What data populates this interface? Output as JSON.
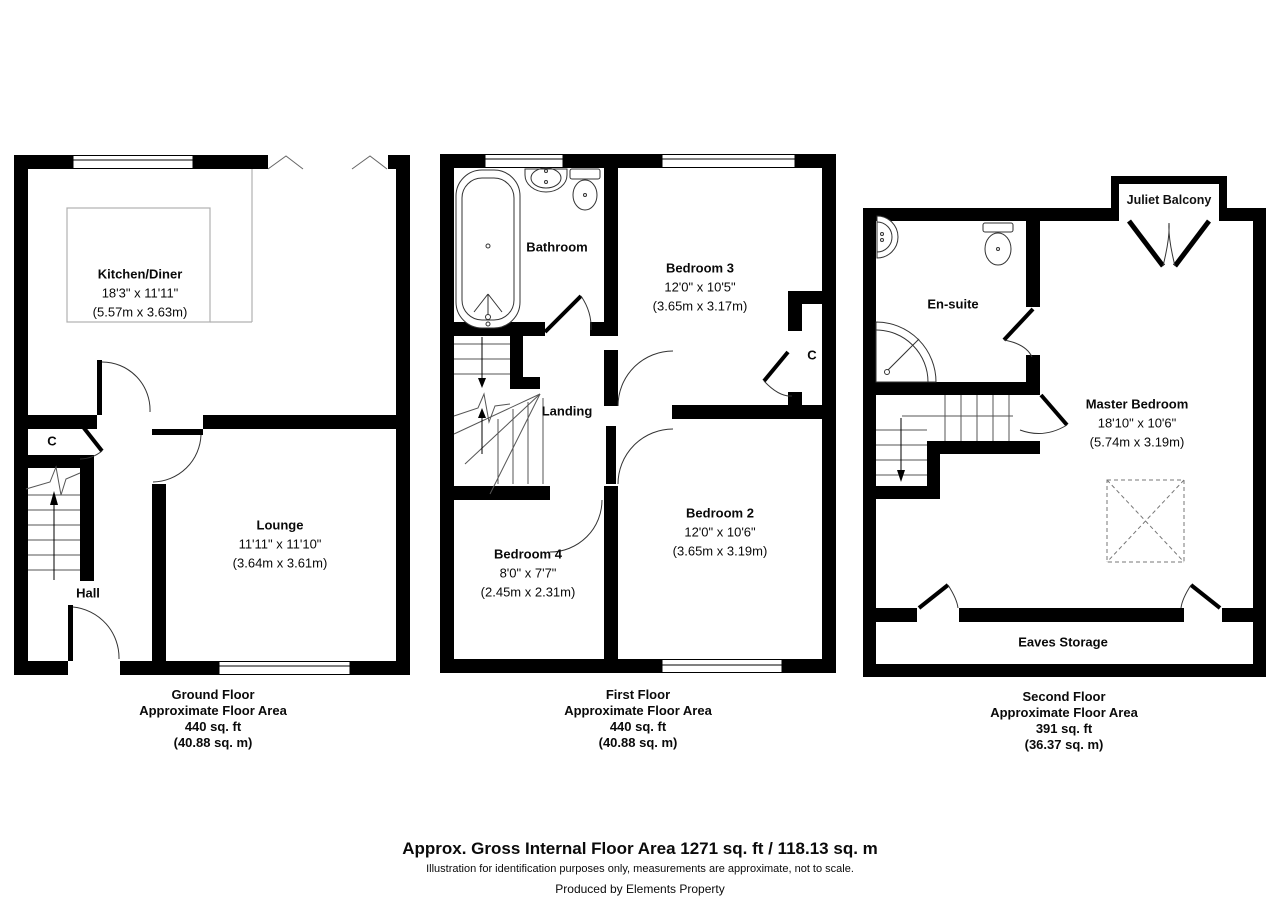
{
  "floors": [
    {
      "id": "ground",
      "caption": {
        "title": "Ground Floor",
        "subtitle": "Approximate Floor Area",
        "area_ft": "440 sq. ft",
        "area_m": "(40.88 sq. m)"
      },
      "rooms": {
        "kitchen_diner": {
          "name": "Kitchen/Diner",
          "dims_ft": "18'3\" x 11'11\"",
          "dims_m": "(5.57m x 3.63m)"
        },
        "lounge": {
          "name": "Lounge",
          "dims_ft": "11'11\" x 11'10\"",
          "dims_m": "(3.64m x 3.61m)"
        },
        "hall": {
          "name": "Hall"
        },
        "cupboard": {
          "name": "C"
        }
      }
    },
    {
      "id": "first",
      "caption": {
        "title": "First Floor",
        "subtitle": "Approximate Floor Area",
        "area_ft": "440 sq. ft",
        "area_m": "(40.88 sq. m)"
      },
      "rooms": {
        "bathroom": {
          "name": "Bathroom"
        },
        "bedroom3": {
          "name": "Bedroom 3",
          "dims_ft": "12'0\" x 10'5\"",
          "dims_m": "(3.65m x 3.17m)"
        },
        "landing": {
          "name": "Landing"
        },
        "cupboard": {
          "name": "C"
        },
        "bedroom2": {
          "name": "Bedroom 2",
          "dims_ft": "12'0\" x 10'6\"",
          "dims_m": "(3.65m x 3.19m)"
        },
        "bedroom4": {
          "name": "Bedroom 4",
          "dims_ft": "8'0\" x 7'7\"",
          "dims_m": "(2.45m x 2.31m)"
        }
      }
    },
    {
      "id": "second",
      "caption": {
        "title": "Second Floor",
        "subtitle": "Approximate Floor Area",
        "area_ft": "391 sq. ft",
        "area_m": "(36.37 sq. m)"
      },
      "rooms": {
        "juliet_balcony": {
          "name": "Juliet Balcony"
        },
        "ensuite": {
          "name": "En-suite"
        },
        "master_bedroom": {
          "name": "Master Bedroom",
          "dims_ft": "18'10\" x 10'6\"",
          "dims_m": "(5.74m x 3.19m)"
        },
        "eaves_storage": {
          "name": "Eaves Storage"
        }
      }
    }
  ],
  "footer": {
    "gross_area": "Approx. Gross Internal Floor Area 1271 sq. ft / 118.13 sq. m",
    "disclaimer": "Illustration for identification purposes only, measurements are approximate, not to scale.",
    "credit": "Produced by Elements Property"
  }
}
